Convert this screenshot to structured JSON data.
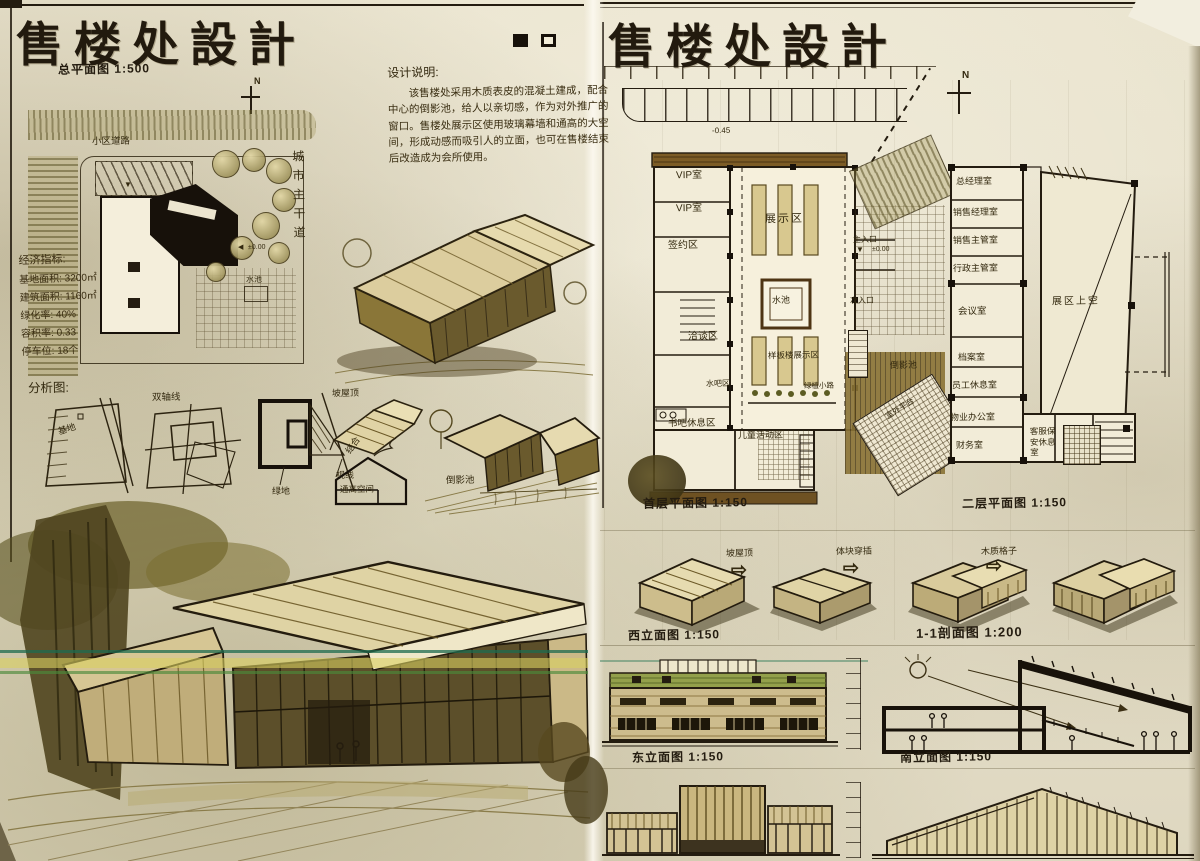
{
  "palette": {
    "paper": "#e8e2cd",
    "ink": "#241c10",
    "wash_olive": "#8a7b42",
    "wash_brown": "#6b4f23",
    "roof_green": "#93a04b",
    "highlight_teal": "#2f7a58",
    "highlight_yellow": "#d8cc52"
  },
  "icons": {
    "north": "N",
    "arrow": "⇨",
    "entry_down": "▼",
    "entry_left": "◀"
  },
  "left": {
    "title": "售楼处設計",
    "site_caption": "总平面图 1:500",
    "site": {
      "road": "小区道路",
      "main_road": "城市主干道",
      "pool": "水池",
      "entry_level": "±0.00"
    },
    "indicators": {
      "heading": "经济指标:",
      "line1": "基地面积: 3200㎡",
      "line2": "建筑面积: 1160㎡",
      "line3": "绿化率: 40%",
      "line4": "容积率: 0.33",
      "line5": "停车位: 18个"
    },
    "notes": {
      "heading": "设计说明:",
      "body": "该售楼处采用木质表皮的混凝土建成，配合中心的倒影池，给人以亲切感，作为对外推广的窗口。售楼处展示区使用玻璃幕墙和通高的大空间，形成动感而吸引人的立面，也可在售楼结束后改造成为会所使用。"
    },
    "analysis": {
      "heading": "分析图:",
      "site_label": "基地",
      "axis_label": "双轴线",
      "green_label": "绿地",
      "sight_label": "视线"
    },
    "concept": {
      "roof": "坡屋顶",
      "combine": "结合",
      "tall_space": "通高空间",
      "pool": "倒影池"
    }
  },
  "right": {
    "title": "售楼处設計",
    "parking_level": "-0.45",
    "floor1": {
      "caption": "首层平面图 1:150",
      "rooms": {
        "vip1": "VIP室",
        "vip2": "VIP室",
        "sign": "签约区",
        "talk": "洽谈区",
        "bar": "水吧区",
        "book": "书吧休息区",
        "show": "展示区",
        "pool": "水池",
        "model": "样板楼展示区",
        "plants": "绿植小路",
        "kids": "儿童活动区",
        "main_entry": "主入口",
        "entry_level": "±0.00",
        "side_entry": "次入口",
        "reflect_pool": "倒影池",
        "terrace": "室外平台"
      }
    },
    "floor2": {
      "caption": "二层平面图 1:150",
      "rooms": {
        "gm": "总经理室",
        "sales_mgr": "销售经理室",
        "sales_sup": "销售主管室",
        "admin_sup": "行政主管室",
        "meeting": "会议室",
        "archive": "档案室",
        "staff": "员工休息室",
        "property": "物业办公室",
        "finance": "财务室",
        "service": "客服保安休息室",
        "void": "展区上空"
      }
    },
    "massing": {
      "step1": "坡屋顶",
      "step2": "体块穿插",
      "step3": "木质格子"
    },
    "captions": {
      "west_elev": "西立面图 1:150",
      "section": "1-1剖面图 1:200",
      "east_elev": "东立面图 1:150",
      "south_elev": "南立面图 1:150"
    }
  }
}
